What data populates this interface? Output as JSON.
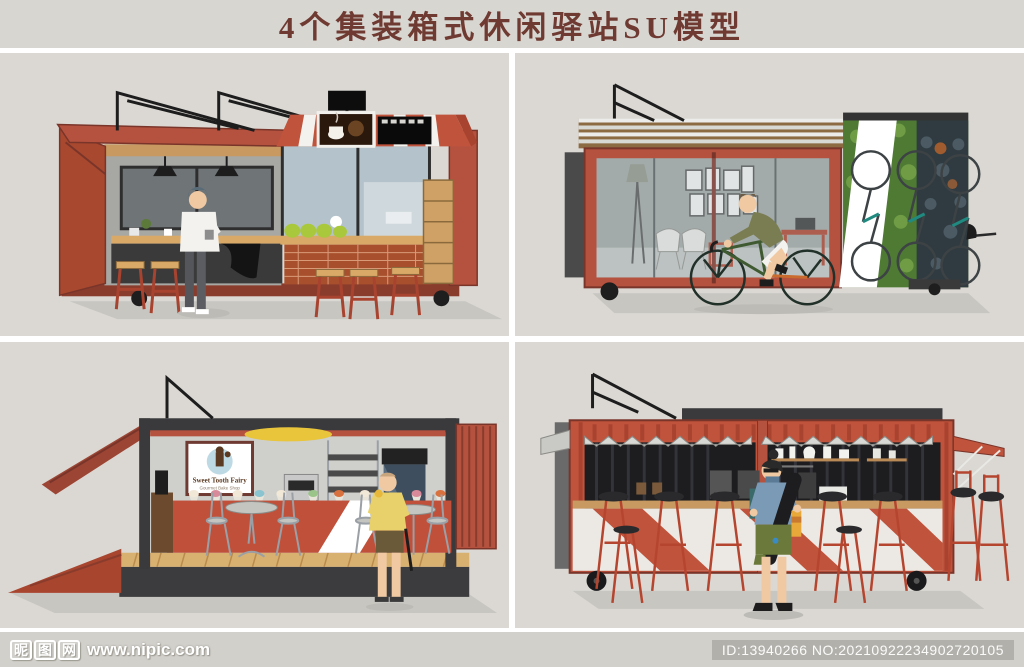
{
  "header": {
    "title": "4个集装箱式休闲驿站SU模型"
  },
  "panels": {
    "top_left": {
      "scene": "red-container-coffee-bar-with-striped-awning-and-stools"
    },
    "top_right": {
      "scene": "red-container-lounge-with-cyclist-green-wall-bike-racks"
    },
    "bottom_left": {
      "scene": "container-bakery-with-deck-tables-and-ramp",
      "sign_brand": "Sweet Tooth Fairy",
      "sign_tagline": "Gourmet Bake Shop"
    },
    "bottom_right": {
      "scene": "corrugated-container-coffee-bar-with-skateboarder-and-stools"
    }
  },
  "footer": {
    "watermark_logo_chars": [
      "昵",
      "图",
      "网"
    ],
    "watermark_url": "www.nipic.com",
    "id_text": "ID:13940266 NO:20210922234902720105"
  },
  "colors": {
    "background": "#d8d6d1",
    "panel_background": "#dbd8d3",
    "title_text": "#6e3a31",
    "container_red": "#b5523f",
    "container_dark_red": "#8a3c2c",
    "frame_dark": "#3a3a3c",
    "wood": "#d0a166",
    "shadow": "#c8c6c1",
    "footer_bar": "#d2d0cb",
    "id_box": "#b2b0ab",
    "green_wall": "#4e7a33",
    "accent_yellow": "#e8d06a"
  }
}
